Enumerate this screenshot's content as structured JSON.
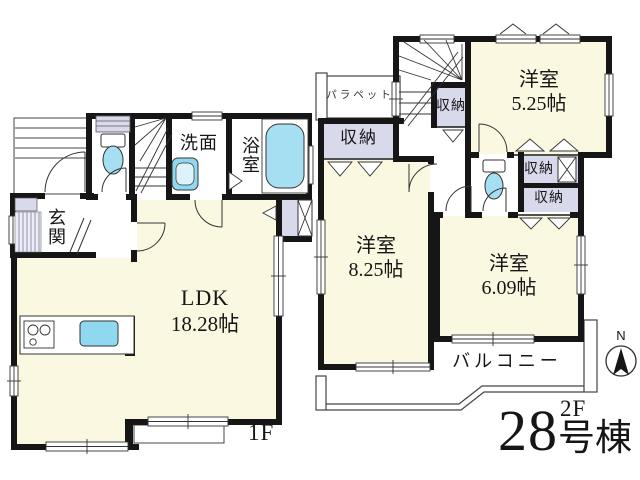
{
  "floor1": {
    "label": "1F",
    "genkan": "玄関",
    "senmen": "洗面",
    "bath": "浴室",
    "ldk_name": "LDK",
    "ldk_size": "18.28帖"
  },
  "floor2": {
    "label": "2F",
    "parapet": "パラペット",
    "storage": "収納",
    "room525_name": "洋室",
    "room525_size": "5.25帖",
    "room825_name": "洋室",
    "room825_size": "8.25帖",
    "room609_name": "洋室",
    "room609_size": "6.09帖",
    "balcony": "バルコニー"
  },
  "building": {
    "number": "28",
    "suffix": "号棟"
  },
  "compass": {
    "north": "N"
  },
  "colors": {
    "room_fill": "#FBF8E2",
    "closet_fill": "#D9D9EC",
    "fixture_blue": "#A6DEF2",
    "sink_blue": "#8FD8F0",
    "wall": "#161616"
  }
}
